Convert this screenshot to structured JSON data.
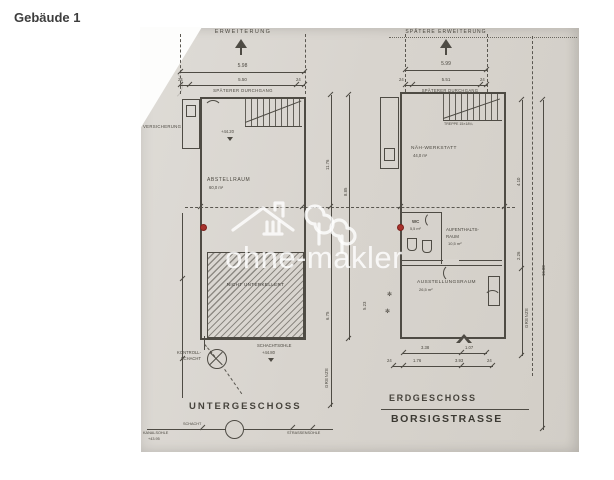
{
  "page": {
    "heading": "Gebäude 1"
  },
  "watermark": {
    "text": "ohne-makler",
    "logo": "house-and-trees"
  },
  "colors": {
    "paper": "#d8d4ce",
    "ink": "#4e4b44",
    "marker_red": "#a8322c",
    "watermark": "#ffffff"
  },
  "b": {
    "title": "UNTERGESCHOSS",
    "extension": "ERWEITERUNG",
    "passage": "SPÄTERER DURCHGANG",
    "insurance": "VERSICHERUNG",
    "level": "+44.20",
    "storage_name": "ABSTELLRAUM",
    "storage_area": "60,0 m²",
    "no_basement": "NICHT UNTERKELLERT",
    "control1": "KONTROLL-",
    "control2": "SCHACHT",
    "sole_label": "SCHACHTSOHLE",
    "sole_level": "+44.80",
    "schacht": "SCHACHT",
    "kanal": "KANALSOHLE",
    "kanal_level": "+43.95",
    "strasse": "STRASSENSOHLE",
    "dim_total": "5.98",
    "dim_inner": "5.50",
    "wall_l": "24",
    "wall_r": "24",
    "h_upper": "11.76",
    "h_inner": "8.85",
    "h_lower": "6.75",
    "h_extra": "5.23",
    "grenze": "GRENZE"
  },
  "g": {
    "title": "ERDGESCHOSS",
    "street": "BORSIGSTRASSE",
    "extension": "SPÄTERE ERWEITERUNG",
    "passage": "SPÄTERER DURCHGANG",
    "stairs": "TREPPE 15×18¼",
    "workshop": "NÄH-WERKSTATT",
    "workshop_area": "44,0 m²",
    "wc": "WC",
    "wc_area": "5,5 m²",
    "lounge1": "AUFENTHALTS-",
    "lounge2": "RAUM",
    "lounge_area": "10,5 m²",
    "exhibition": "AUSSTELLUNGSRAUM",
    "exhibition_area": "26,5 m²",
    "dim_total": "5.99",
    "dim_inner": "5.51",
    "wall_l": "24",
    "wall_r": "24",
    "r_upper": "4.10",
    "r_mid": "2.26",
    "r_outer": "16.00",
    "b1": "3.38",
    "b2": "1.07",
    "b3": "1.76",
    "b4": "3.93",
    "b5": "24",
    "b6": "24",
    "symbol": "✻",
    "grenze": "GRENZE"
  }
}
